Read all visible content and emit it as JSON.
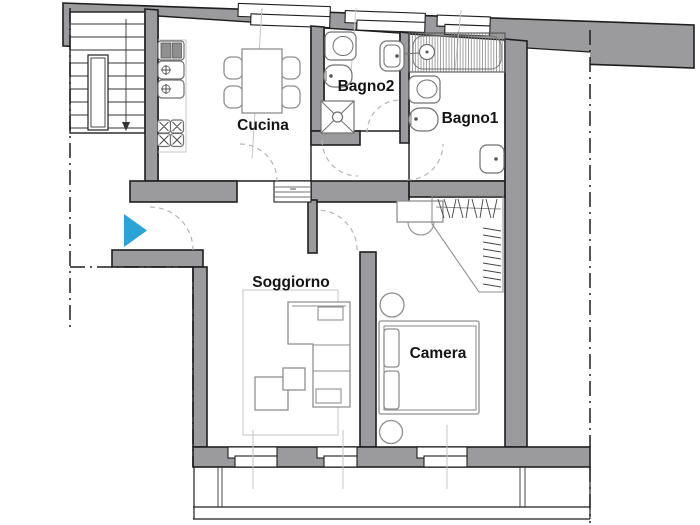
{
  "rooms": {
    "cucina": "Cucina",
    "bagno2": "Bagno2",
    "bagno1": "Bagno1",
    "soggiorno": "Soggiorno",
    "camera": "Camera"
  },
  "colors": {
    "wall": "#9b9b9d",
    "outline": "#1e1e1e",
    "furniture_line": "#8f8f8f",
    "light_line": "#c6c6c6",
    "hatch_line": "#8a8a8a",
    "door_arc": "#b5b5b5",
    "entrance_arrow": "#2aa3d6",
    "background": "#ffffff"
  },
  "icons": {
    "entrance": "entrance-arrow"
  }
}
